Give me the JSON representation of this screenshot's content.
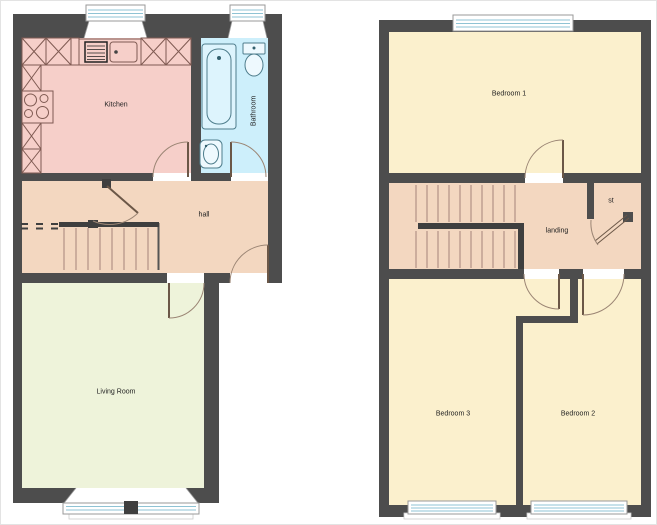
{
  "plan": {
    "title": "two-storey house floorplan",
    "ground_floor": {
      "name": "ground-floor",
      "rooms": [
        {
          "id": "kitchen",
          "label": "Kitchen"
        },
        {
          "id": "bathroom",
          "label": "Bathroom"
        },
        {
          "id": "hall",
          "label": "hall"
        },
        {
          "id": "living_room",
          "label": "Living Room"
        }
      ]
    },
    "first_floor": {
      "name": "first-floor",
      "rooms": [
        {
          "id": "bedroom_1",
          "label": "Bedroom 1"
        },
        {
          "id": "landing",
          "label": "landing"
        },
        {
          "id": "store",
          "label": "st"
        },
        {
          "id": "bedroom_3",
          "label": "Bedroom 3"
        },
        {
          "id": "bedroom_2",
          "label": "Bedroom 2"
        }
      ]
    },
    "palette": {
      "wall": "#4d4d4d",
      "kitchen": "#f6cfc9",
      "bathroom": "#cdeffb",
      "hall_landing": "#f3d7c0",
      "living_room": "#eef3da",
      "bedroom": "#fbf0cd",
      "glazing": "#8fc3d4"
    }
  }
}
